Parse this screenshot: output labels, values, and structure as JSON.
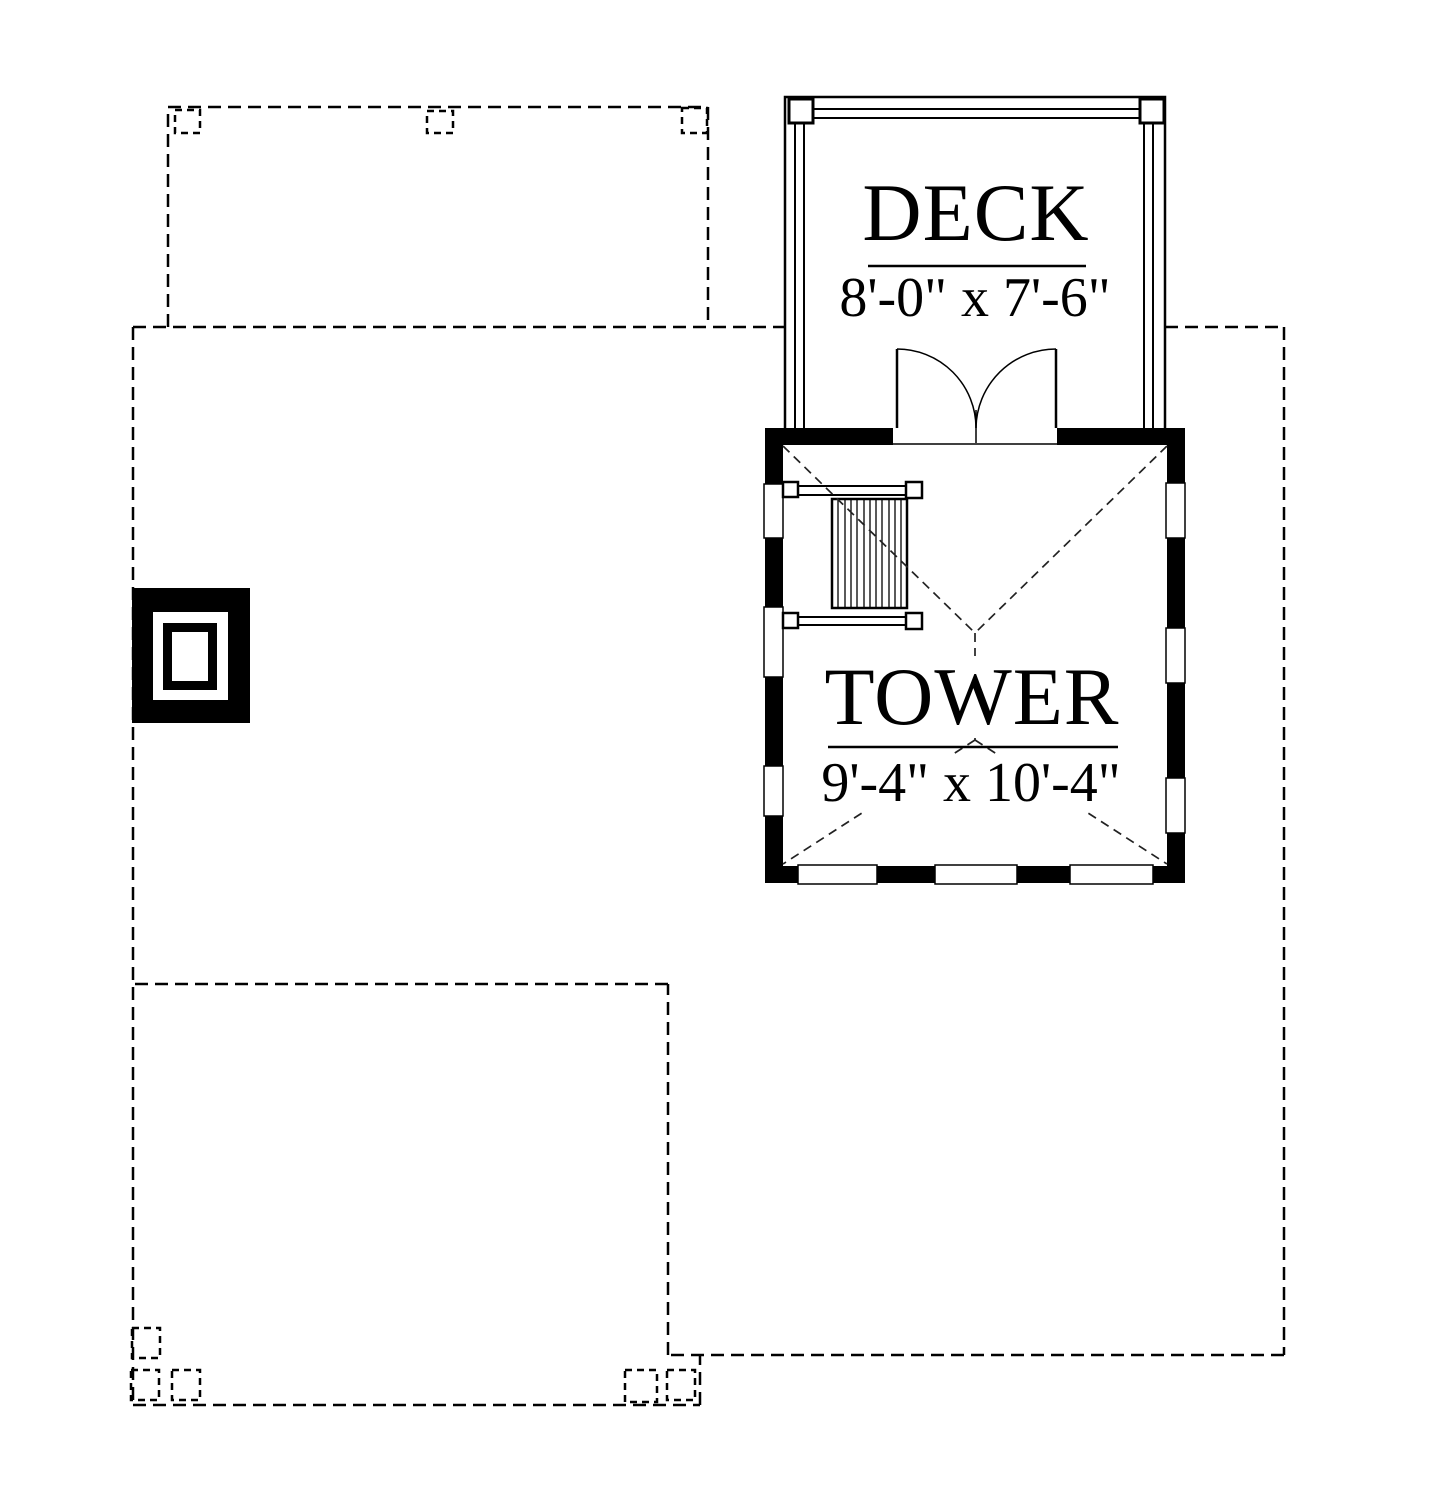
{
  "rooms": {
    "deck": {
      "name": "DECK",
      "size": "8'-0\" x 7'-6\""
    },
    "tower": {
      "name": "TOWER",
      "size": "9'-4\" x 10'-4\""
    }
  },
  "colors": {
    "line": "#000000",
    "hip_dash": "#222222",
    "background": "#ffffff"
  }
}
